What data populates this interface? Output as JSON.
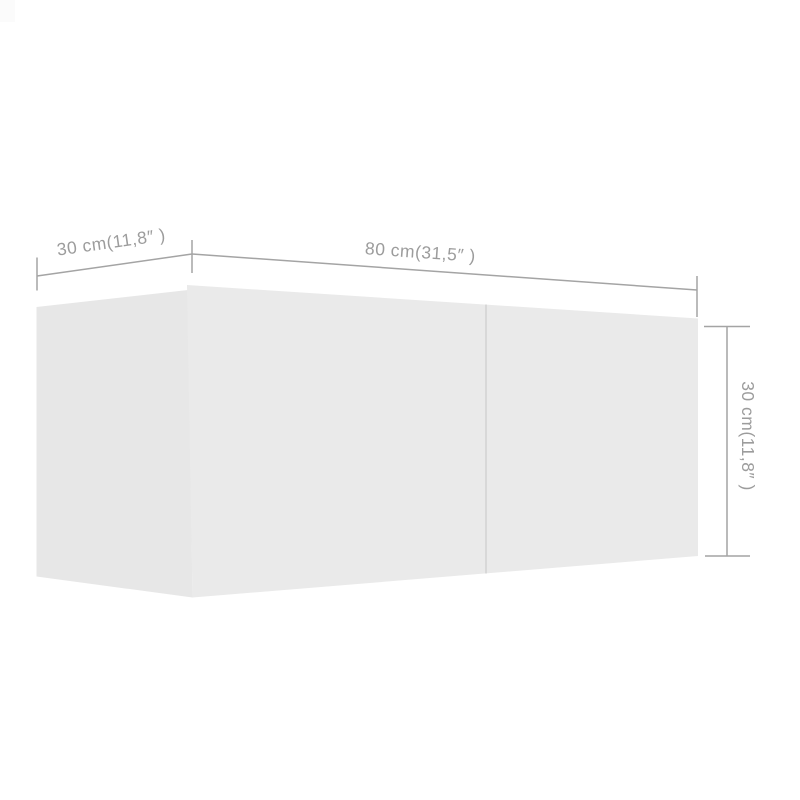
{
  "labels": {
    "depth": "30 cm(11,8″ )",
    "width": "80 cm(31,5″ )",
    "height": "30 cm(11,8″ )"
  },
  "colors": {
    "background": "#ffffff",
    "side_face": "#e7e7e7",
    "front_face": "#eaeaea",
    "door_divider": "#d8d8d8",
    "dimension_line": "#a4a4a4",
    "label_text": "#9c9c9c",
    "corner_artifact": "#fbfbfb"
  }
}
